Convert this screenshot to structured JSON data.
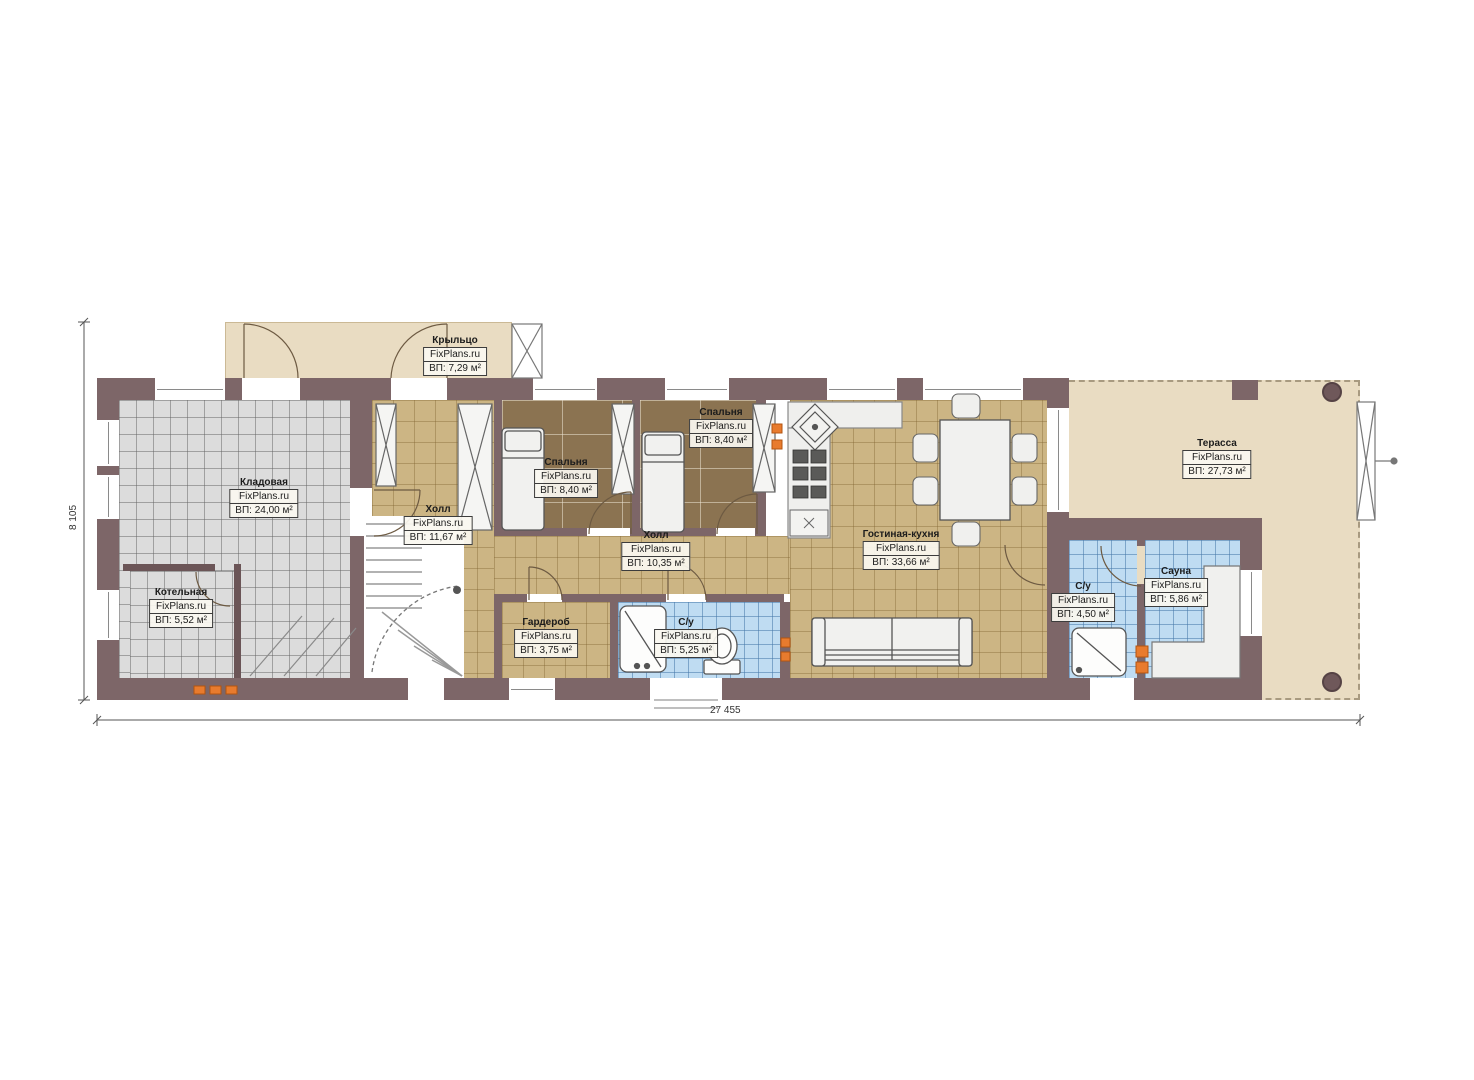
{
  "dimensions": {
    "width_label": "27 455",
    "height_label": "8 105"
  },
  "rooms": [
    {
      "id": "porch",
      "name": "Крыльцо",
      "brand": "FixPlans.ru",
      "area": "ВП: 7,29 м²"
    },
    {
      "id": "storage",
      "name": "Кладовая",
      "brand": "FixPlans.ru",
      "area": "ВП: 24,00 м²"
    },
    {
      "id": "boiler",
      "name": "Котельная",
      "brand": "FixPlans.ru",
      "area": "ВП: 5,52 м²"
    },
    {
      "id": "hall1",
      "name": "Холл",
      "brand": "FixPlans.ru",
      "area": "ВП: 11,67 м²"
    },
    {
      "id": "bedroom1",
      "name": "Спальня",
      "brand": "FixPlans.ru",
      "area": "ВП: 8,40 м²"
    },
    {
      "id": "bedroom2",
      "name": "Спальня",
      "brand": "FixPlans.ru",
      "area": "ВП: 8,40 м²"
    },
    {
      "id": "hall2",
      "name": "Холл",
      "brand": "FixPlans.ru",
      "area": "ВП: 10,35 м²"
    },
    {
      "id": "wardrobe",
      "name": "Гардероб",
      "brand": "FixPlans.ru",
      "area": "ВП: 3,75 м²"
    },
    {
      "id": "bath1",
      "name": "С/у",
      "brand": "FixPlans.ru",
      "area": "ВП: 5,25 м²"
    },
    {
      "id": "living",
      "name": "Гостиная-кухня",
      "brand": "FixPlans.ru",
      "area": "ВП: 33,66 м²"
    },
    {
      "id": "bath2",
      "name": "С/у",
      "brand": "FixPlans.ru",
      "area": "ВП: 4,50 м²"
    },
    {
      "id": "sauna",
      "name": "Сауна",
      "brand": "FixPlans.ru",
      "area": "ВП: 5,86 м²"
    },
    {
      "id": "terrace",
      "name": "Терасса",
      "brand": "FixPlans.ru",
      "area": "ВП: 27,73 м²"
    }
  ],
  "colors": {
    "wall": "#7d6668",
    "floor_tan": "#ccb584",
    "floor_wood": "#8b7351",
    "floor_gray": "#dcdcdc",
    "floor_blue": "#bfdcf2",
    "outdoor_beige": "#e9dcc2",
    "accent_orange": "#e87b2e"
  }
}
